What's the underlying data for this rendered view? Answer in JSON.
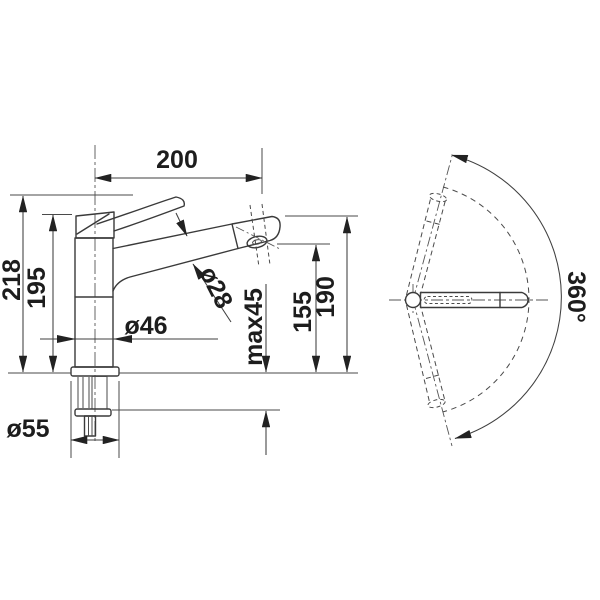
{
  "drawing": {
    "title": "Kitchen mixer tap dimensional drawing",
    "background_color": "#ffffff",
    "line_color": "#3a3a3a",
    "text_color": "#1d1d1d",
    "views": {
      "front_view": "side elevation of tap with installation dimensions",
      "top_view": "plan view showing spout swivel range"
    },
    "dimensions": {
      "spout_reach": "200",
      "total_height": "218",
      "body_height": "195",
      "spout_diameter": "ø28",
      "body_diameter": "ø46",
      "base_diameter": "ø55",
      "max_counter_thickness": "max45",
      "outlet_height": "155",
      "head_height": "190",
      "swivel_range": "360°"
    }
  }
}
